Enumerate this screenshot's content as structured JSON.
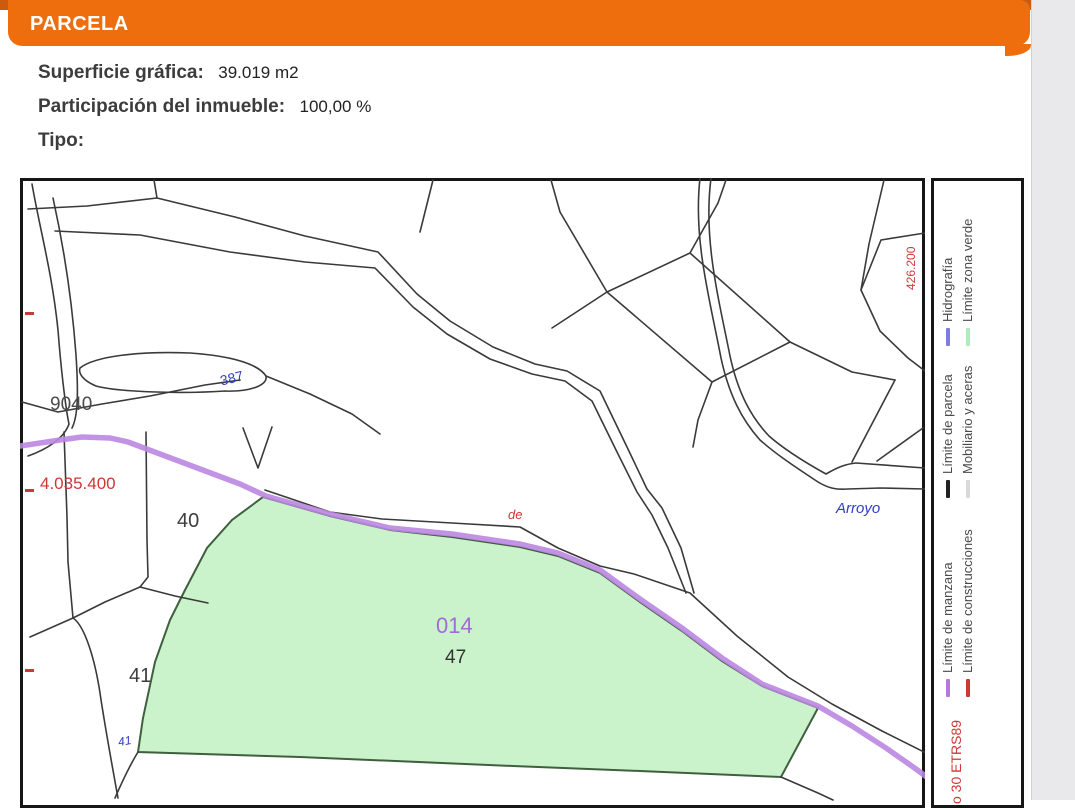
{
  "header": {
    "title": "PARCELA"
  },
  "details": {
    "superficie_label": "Superficie gráfica:",
    "superficie_value": "39.019 m2",
    "participacion_label": "Participación del inmueble:",
    "participacion_value": "100,00 %",
    "tipo_label": "Tipo:"
  },
  "map": {
    "parcel_labels": [
      {
        "name": "block-label-9040",
        "text": "9040",
        "color": "#4a4a4a",
        "x": 50,
        "y": 395,
        "size": 19
      },
      {
        "name": "point-label-387",
        "text": "387",
        "color": "#2f3fbf",
        "x": 220,
        "y": 371,
        "size": 14,
        "rotate": -14
      },
      {
        "name": "y-coordinate-label",
        "text": "4.035.400",
        "color": "#cc3836",
        "x": 40,
        "y": 475,
        "size": 17
      },
      {
        "name": "parcel-label-40",
        "text": "40",
        "color": "#3d3d3d",
        "x": 177,
        "y": 511,
        "size": 20
      },
      {
        "name": "parcel-label-41",
        "text": "41",
        "color": "#3d3d3d",
        "x": 129,
        "y": 666,
        "size": 20
      },
      {
        "name": "vertex-label-41",
        "text": "41",
        "color": "#2f3fbf",
        "x": 118,
        "y": 735,
        "size": 12,
        "rotate": -10,
        "italic": true
      },
      {
        "name": "manzana-label-014",
        "text": "014",
        "color": "#a06cd5",
        "x": 436,
        "y": 615,
        "size": 22
      },
      {
        "name": "parcel-label-47",
        "text": "47",
        "color": "#333333",
        "x": 445,
        "y": 648,
        "size": 19
      },
      {
        "name": "street-label-de",
        "text": "de",
        "color": "#cc3836",
        "x": 508,
        "y": 508,
        "size": 13,
        "italic": true
      },
      {
        "name": "stream-label-arroyo",
        "text": "Arroyo",
        "color": "#2f3fbf",
        "x": 836,
        "y": 501,
        "size": 15,
        "italic": true
      }
    ],
    "x_coordinate_label": {
      "text": "426.200",
      "color": "#cc3836",
      "x": 905,
      "y": 290,
      "size": 12
    },
    "ticks": [
      {
        "x": 25,
        "y": 312
      },
      {
        "x": 25,
        "y": 489
      },
      {
        "x": 25,
        "y": 669
      }
    ],
    "tick_color": "#cc3836",
    "highlight_parcel_fill": "#cbf3cb",
    "highlight_parcel_stroke": "#3f5f3f",
    "manzana_line_color": "#bb87e2",
    "line_color": "#3a3a3a"
  },
  "legend": {
    "items": [
      {
        "label": "Hidrografía",
        "color": "#7d7de0",
        "x": 941,
        "y": 346
      },
      {
        "label": "Límite zona verde",
        "color": "#aeeabc",
        "x": 961,
        "y": 346
      },
      {
        "label": "Límite de parcela",
        "color": "#222222",
        "x": 941,
        "y": 498
      },
      {
        "label": "Mobiliario y aceras",
        "color": "#d9d9d9",
        "x": 961,
        "y": 498
      },
      {
        "label": "Límite de manzana",
        "color": "#b678e0",
        "x": 941,
        "y": 697
      },
      {
        "label": "Límite de construcciones",
        "color": "#cc3a36",
        "x": 961,
        "y": 697
      }
    ],
    "datum_label": {
      "text": "o 30 ETRS89",
      "color": "#cc3836",
      "x": 949,
      "y": 804,
      "size": 14
    }
  },
  "colors": {
    "accent_orange": "#ee6e0e",
    "accent_orange_dark": "#cd5b0e"
  }
}
